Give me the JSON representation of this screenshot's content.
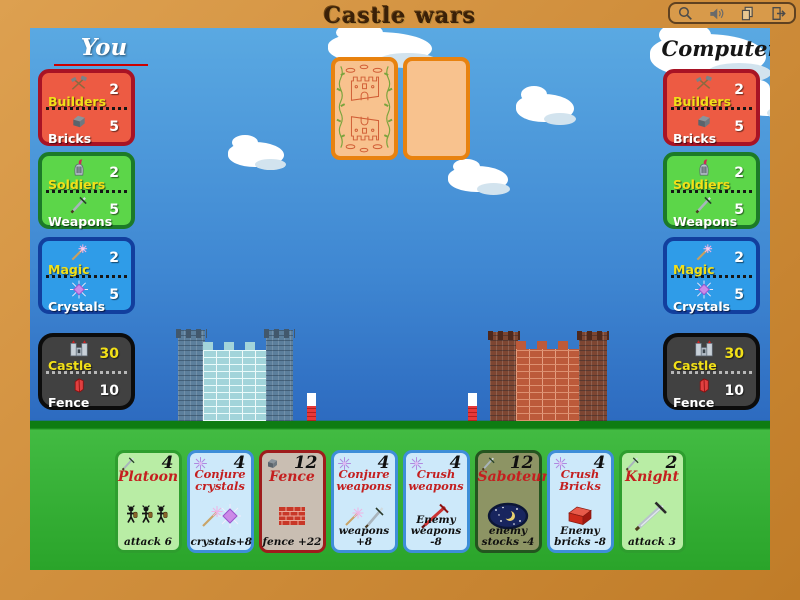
{
  "title": "Castle wars",
  "toolbar": {
    "icons": [
      "magnifier-icon",
      "sound-icon",
      "pages-icon",
      "exit-icon"
    ]
  },
  "players": {
    "you": {
      "name": "You",
      "panels": [
        {
          "row1_label": "Builders",
          "row1_value": "2",
          "row2_label": "Bricks",
          "row2_value": "5"
        },
        {
          "row1_label": "Soldiers",
          "row1_value": "2",
          "row2_label": "Weapons",
          "row2_value": "5"
        },
        {
          "row1_label": "Magic",
          "row1_value": "2",
          "row2_label": "Crystals",
          "row2_value": "5"
        },
        {
          "row1_label": "Castle",
          "row1_value": "30",
          "row2_label": "Fence",
          "row2_value": "10"
        }
      ]
    },
    "computer": {
      "name": "Computer",
      "panels": [
        {
          "row1_label": "Builders",
          "row1_value": "2",
          "row2_label": "Bricks",
          "row2_value": "5"
        },
        {
          "row1_label": "Soldiers",
          "row1_value": "2",
          "row2_label": "Weapons",
          "row2_value": "5"
        },
        {
          "row1_label": "Magic",
          "row1_value": "2",
          "row2_label": "Crystals",
          "row2_value": "5"
        },
        {
          "row1_label": "Castle",
          "row1_value": "30",
          "row2_label": "Fence",
          "row2_value": "10"
        }
      ]
    }
  },
  "hand": [
    {
      "title": "Platoon",
      "cost": "4",
      "effect": "attack  6",
      "type": "attack"
    },
    {
      "title": "Conjure crystals",
      "cost": "4",
      "effect": "crystals+8",
      "type": "magic"
    },
    {
      "title": "Fence",
      "cost": "12",
      "effect": "fence +22",
      "type": "brick"
    },
    {
      "title": "Conjure weapons",
      "cost": "4",
      "effect": "weapons +8",
      "type": "magic"
    },
    {
      "title": "Crush weapons",
      "cost": "4",
      "effect": "Enemy weapons -8",
      "type": "magic"
    },
    {
      "title": "Saboteur",
      "cost": "12",
      "effect": "enemy stocks -4",
      "type": "attack"
    },
    {
      "title": "Crush Bricks",
      "cost": "4",
      "effect": "Enemy bricks -8",
      "type": "magic"
    },
    {
      "title": "Knight",
      "cost": "2",
      "effect": "attack  3",
      "type": "attack"
    }
  ],
  "colors": {
    "frame": "#d2913f",
    "sky_top": "#5aa9e2",
    "sky_bottom": "#2d6bc0",
    "grass": "#42bb42",
    "panel_red": "#ed5b43",
    "panel_green": "#5cd649",
    "panel_blue": "#2f9ce8",
    "panel_dark": "#414141",
    "card_back": "#f8c28e",
    "card_orange_border": "#e8820f",
    "card_title_red": "#c41f1f",
    "label_yellow": "#f2e018",
    "castle_left": "#a2d4da",
    "castle_right": "#bc5a3a"
  }
}
